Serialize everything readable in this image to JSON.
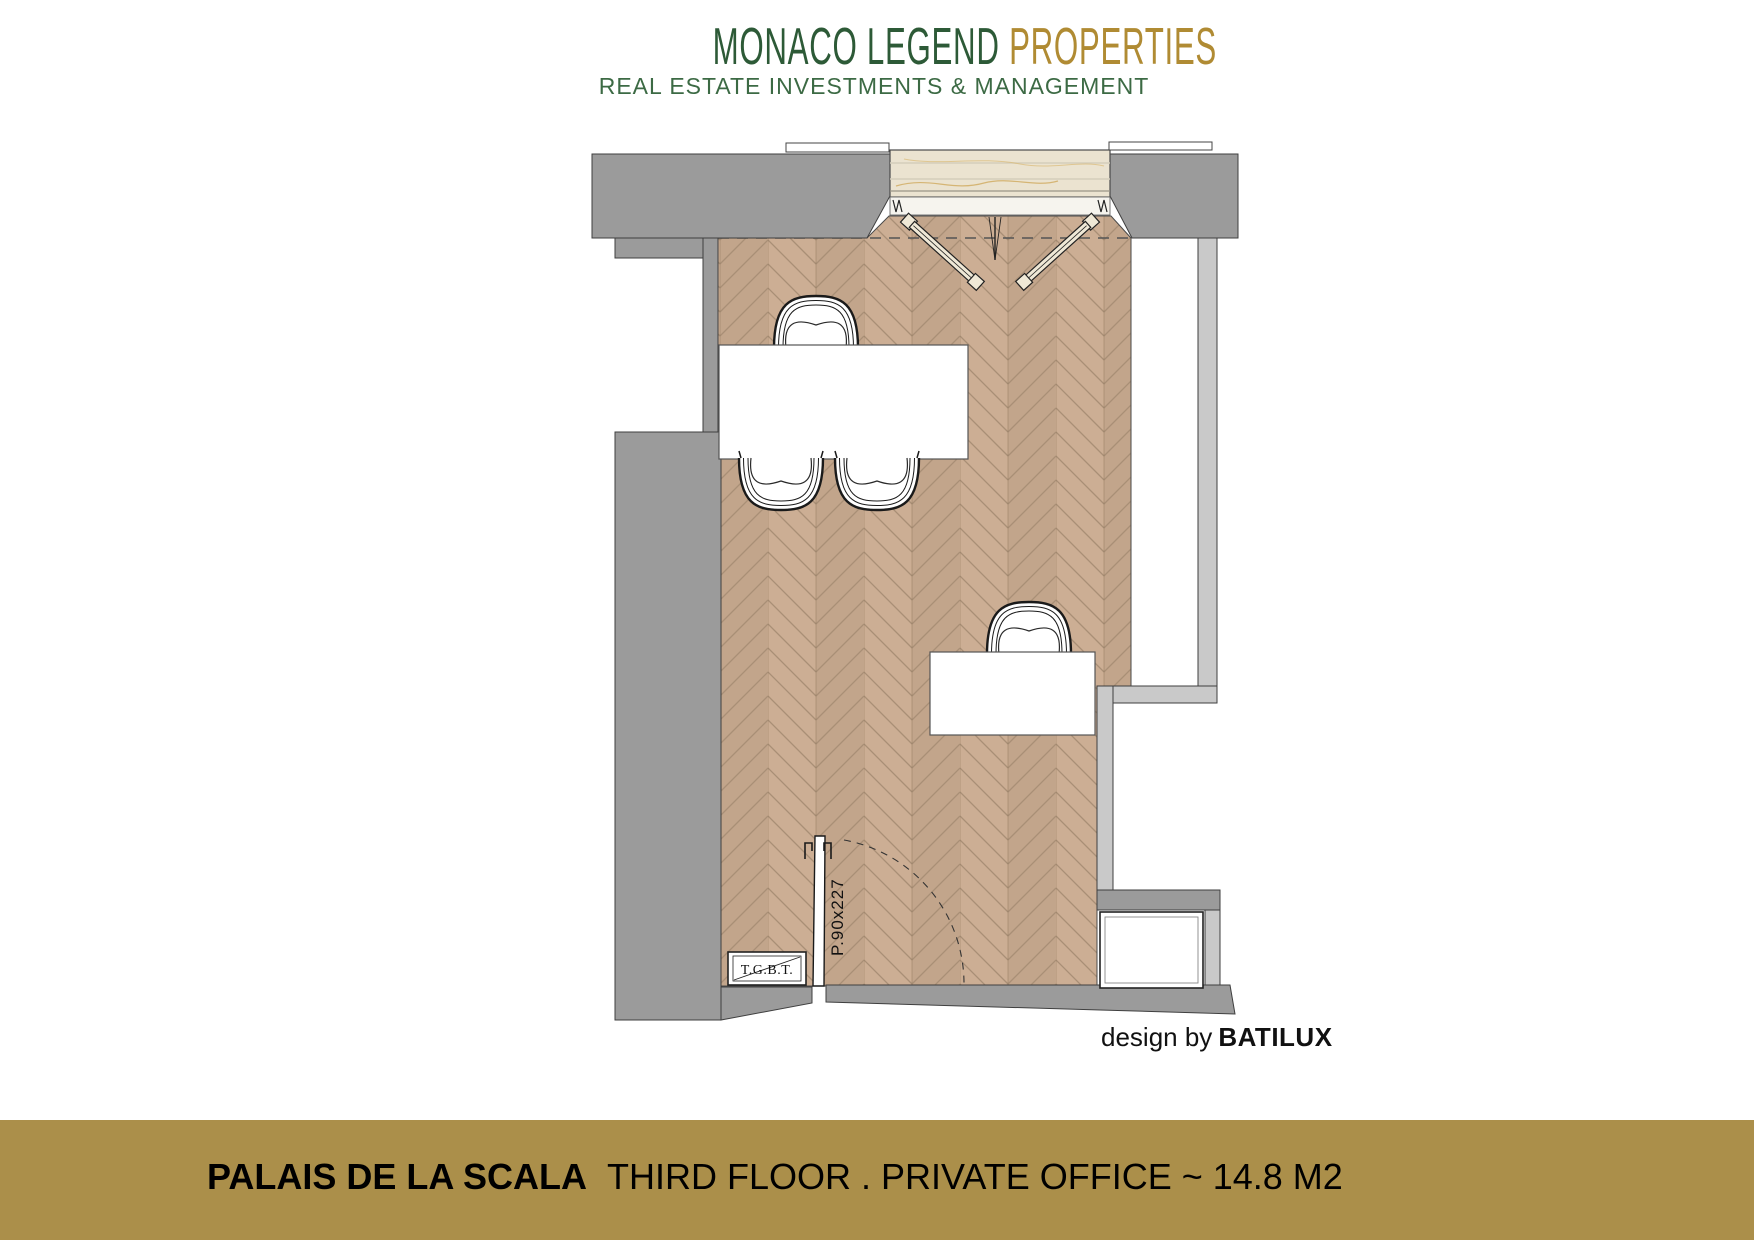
{
  "logo": {
    "brand_primary": "MONACO LEGEND",
    "brand_secondary": "PROPERTIES",
    "tagline": "REAL ESTATE INVESTMENTS & MANAGEMENT"
  },
  "plan": {
    "door_label": "P.90x227",
    "panel_label": "T.G.B.T."
  },
  "credit": {
    "prefix": "design by",
    "brand": "BATILUX"
  },
  "footer": {
    "building": "PALAIS DE LA SCALA",
    "details": "THIRD FLOOR . PRIVATE OFFICE  ~  14.8 M2"
  },
  "colors": {
    "logo_green": "#2d5a37",
    "logo_gold": "#b08b33",
    "band_gold": "#ab8f4a",
    "wall_dark_gray": "#9b9b9b",
    "wall_light_gray": "#c9c9c9",
    "floor_tan": "#c9ac92",
    "marble_beige": "#ebe3d0"
  }
}
